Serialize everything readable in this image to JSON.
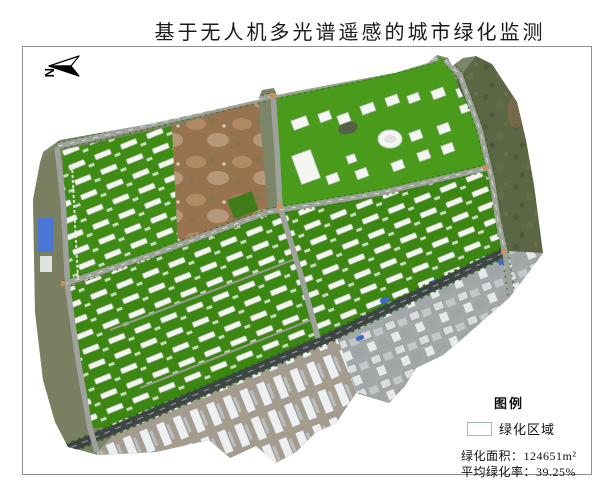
{
  "title": "基于无人机多光谱遥感的城市绿化监测",
  "north_arrow": {
    "label": "N"
  },
  "legend": {
    "title": "图例",
    "items": [
      {
        "label": "绿化区域",
        "swatch_fill": "#ffffff",
        "swatch_border": "#9cc39b"
      }
    ],
    "stats": [
      {
        "text": "绿化面积：124651m²"
      },
      {
        "text": "平均绿化率：39.25%"
      }
    ]
  },
  "colors": {
    "vegetation_green": "#3f8c14",
    "campus_lawn_green": "#4a9a1c",
    "bare_soil_brown": "#97744f",
    "road_gray": "#9fa29c",
    "avenue_dark": "#3e4645",
    "urban_gray": "#a2a7a8",
    "scrub_dark_green": "#5a6644",
    "legend_swatch_border": "#9cc39b"
  }
}
